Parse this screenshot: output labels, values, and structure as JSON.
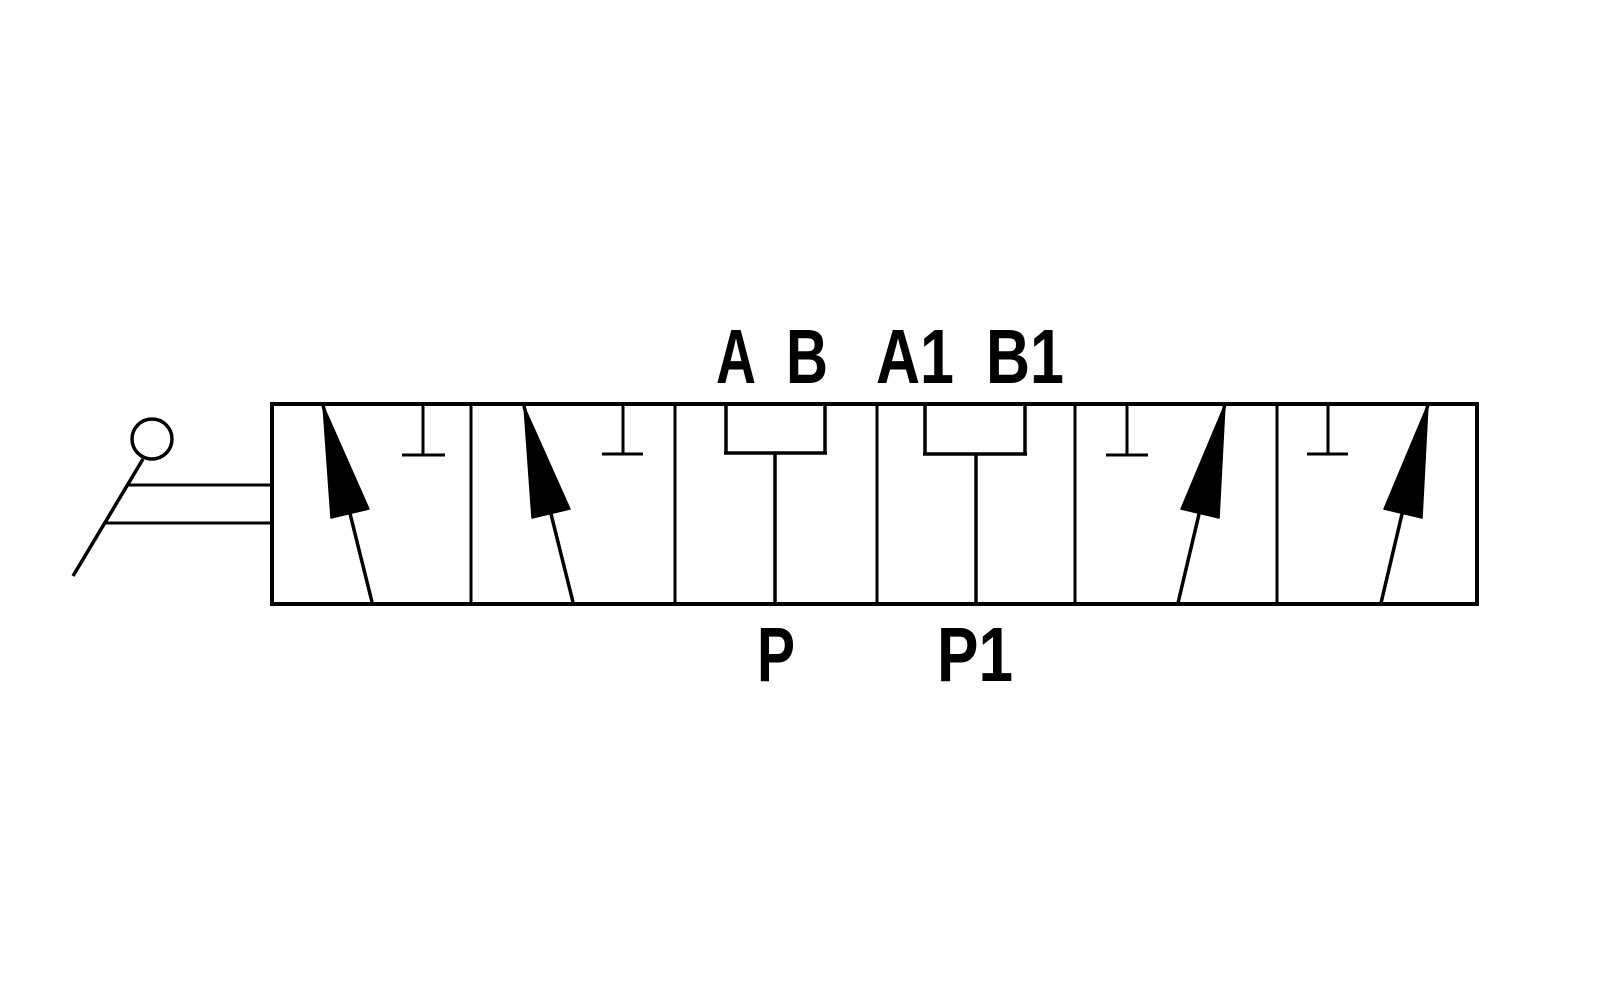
{
  "figure": {
    "kind": "directional-control-valve-schematic"
  },
  "colors": {
    "line": "#000000",
    "background": "#ffffff"
  },
  "ports": {
    "a": "A",
    "b": "B",
    "a1": "A1",
    "b1": "B1",
    "p": "P",
    "p1": "P1"
  },
  "symbols": {
    "lever": "manual-lever-icon",
    "flow_arrow": "flow-arrow-icon",
    "blocked_port": "blocked-port-icon",
    "port_bracket": "port-bracket-connector"
  }
}
